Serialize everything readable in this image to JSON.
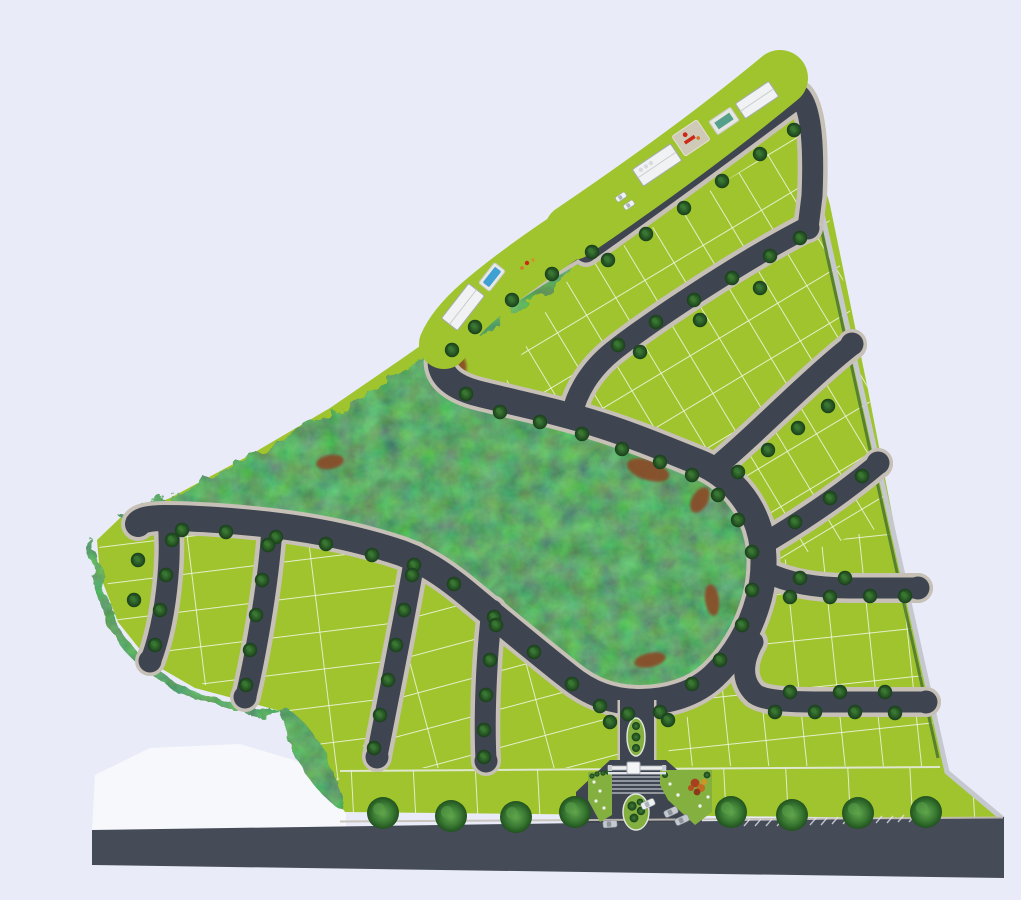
{
  "scene": {
    "title": "Residential land subdivision master plan — aerial site render",
    "view": "Top-down 3D rendered site plan of a fan-shaped parcel",
    "features": [
      "Gated entrance with landscaped boulevard islands and flower beds",
      "Central preserved forest hill encircled by a loop road",
      "Clubhouse buildings, two pools, playground and parked cars along the north-west amenity strip",
      "Residential streets with cul-de-sac bulbs and street trees",
      "Rows of green lots divided by white boundary lines",
      "Main public road along the southern frontage with large shade trees"
    ],
    "road_markings": "White hatch ticks on the main road east of the entrance; striped paving at the gate"
  },
  "colors": {
    "background": "#e9ecf8",
    "outside_white": "#f6f8fc",
    "lot_green": "#a0c42e",
    "lot_line": "#f2f6e9",
    "road": "#3e4450",
    "road_main": "#454b57",
    "sidewalk": "#c6c0b7",
    "forest_base": "#3c6a33",
    "dirt_brown": "#8a4a26",
    "pool_blue": "#3fa0d4",
    "pool_teal": "#55a08b",
    "building_white": "#f1f2f3",
    "building_stroke": "#a6abb0",
    "island_green": "#84b040",
    "hedge_green": "#4a7531",
    "flower_red": "#a84020",
    "flower_orange": "#c06a22",
    "flower_yellow": "#d09526",
    "car_white": "#eef0f2",
    "car_silver": "#c6cad0",
    "boundary_gray": "#c5c8cf"
  }
}
